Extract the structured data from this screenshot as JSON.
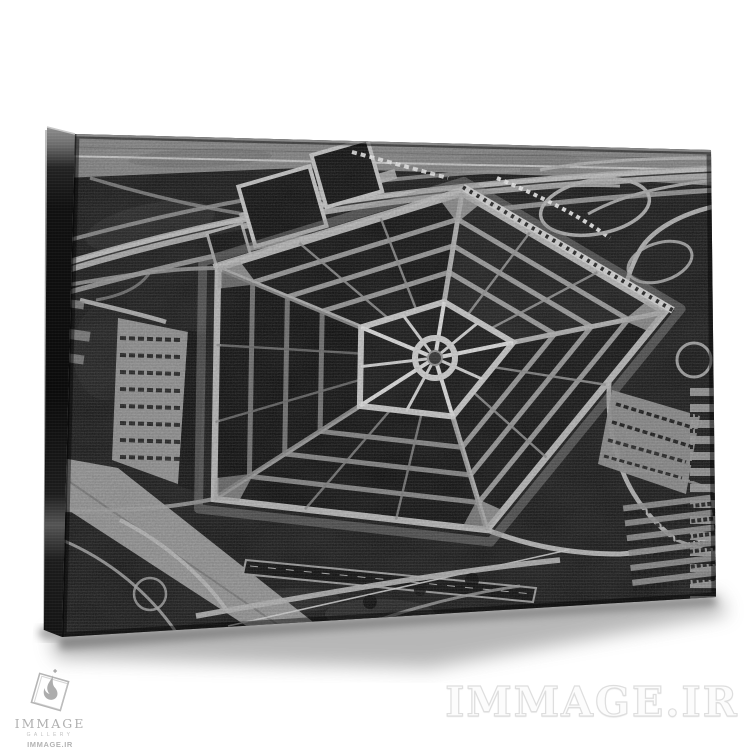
{
  "page": {
    "background_color": "#ffffff"
  },
  "watermark": {
    "text": "IMMAGE.IR"
  },
  "logo": {
    "brand": "IMMAGE",
    "subtitle": "GALLERY",
    "domain": "IMMAGE.IR"
  },
  "colors": {
    "background": "#ffffff",
    "photo_dark": "#121212",
    "photo_light": "#b5b5b5",
    "watermark_fill": "#ffffff",
    "watermark_outline": "#dedede",
    "logo_gray": "#b3b3b3"
  }
}
